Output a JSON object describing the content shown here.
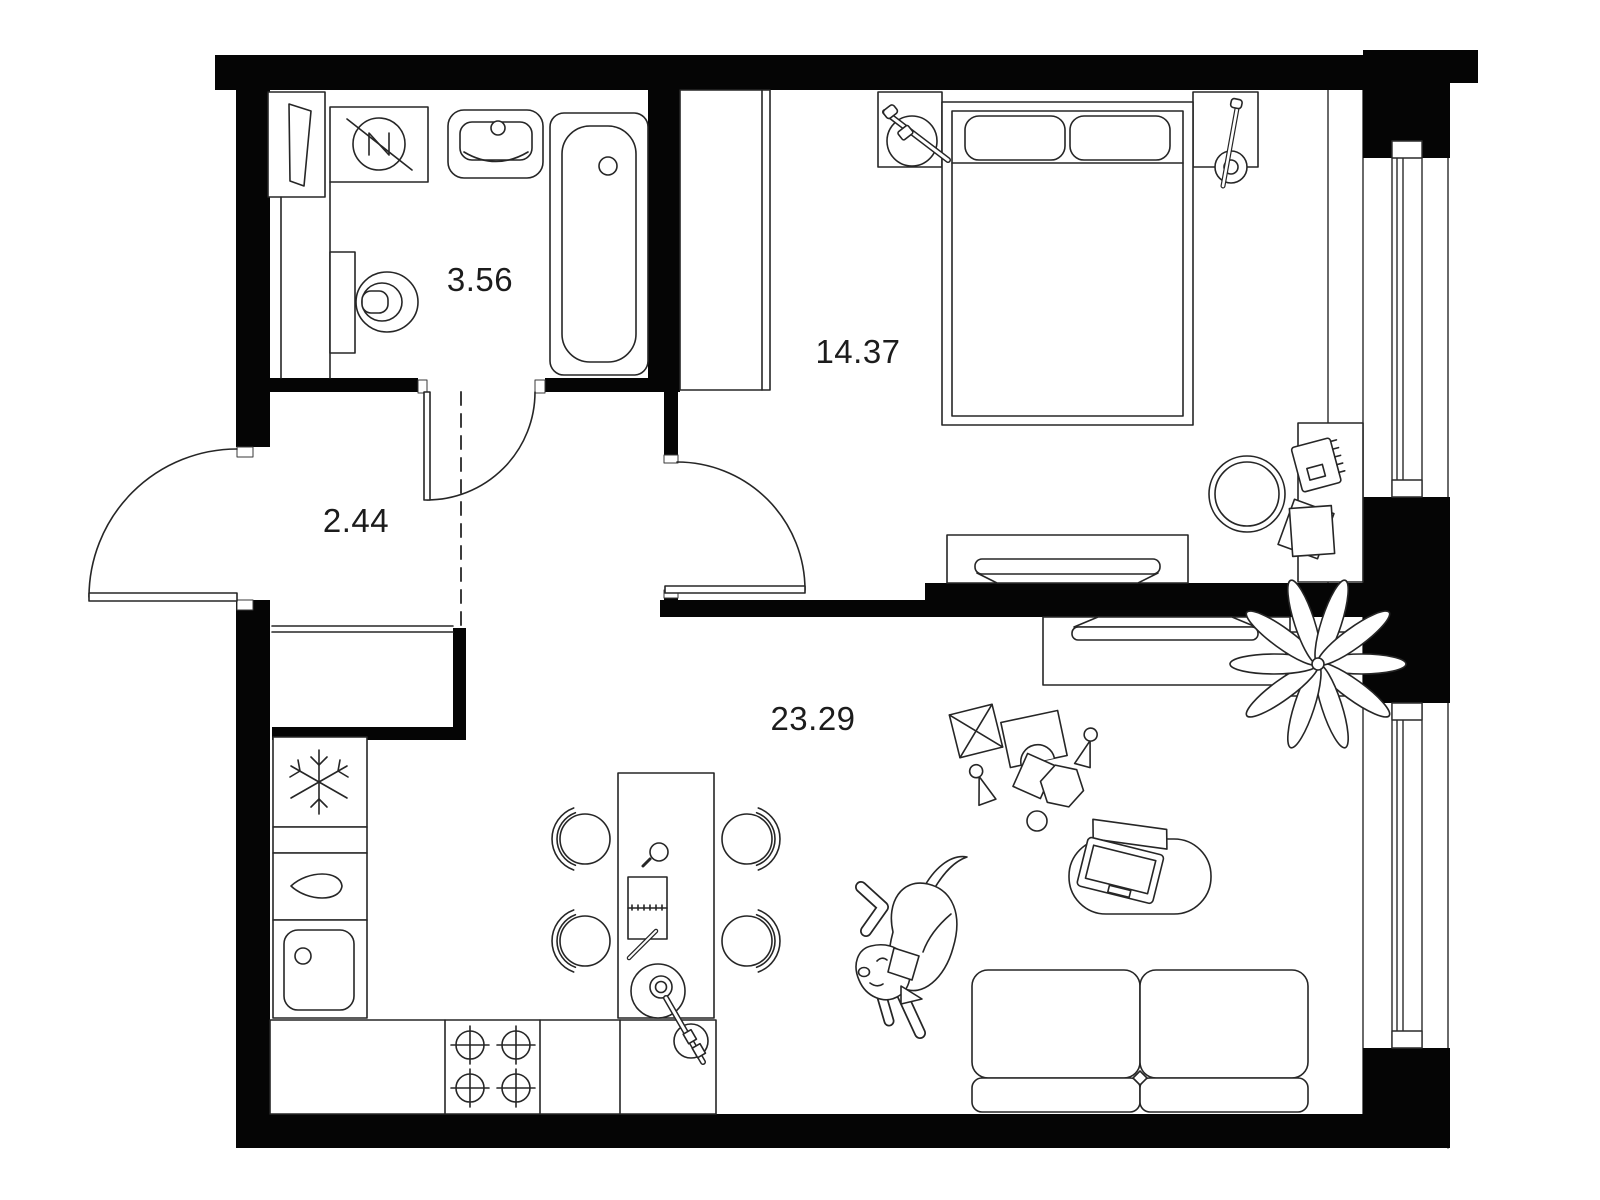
{
  "rooms": [
    {
      "id": "bathroom",
      "area_label": "3.56"
    },
    {
      "id": "hallway",
      "area_label": "2.44"
    },
    {
      "id": "bedroom",
      "area_label": "14.37"
    },
    {
      "id": "living-kitchen",
      "area_label": "23.29"
    }
  ],
  "icons": {
    "freezer": "snowflake-icon",
    "dishwasher": "teardrop-icon",
    "washing_machine": "crossed-circle-icon",
    "stove": "burner-circles-icon"
  },
  "colors": {
    "wall": "#050505",
    "line": "#262626",
    "background": "#ffffff",
    "text": "#1c1c1c"
  }
}
